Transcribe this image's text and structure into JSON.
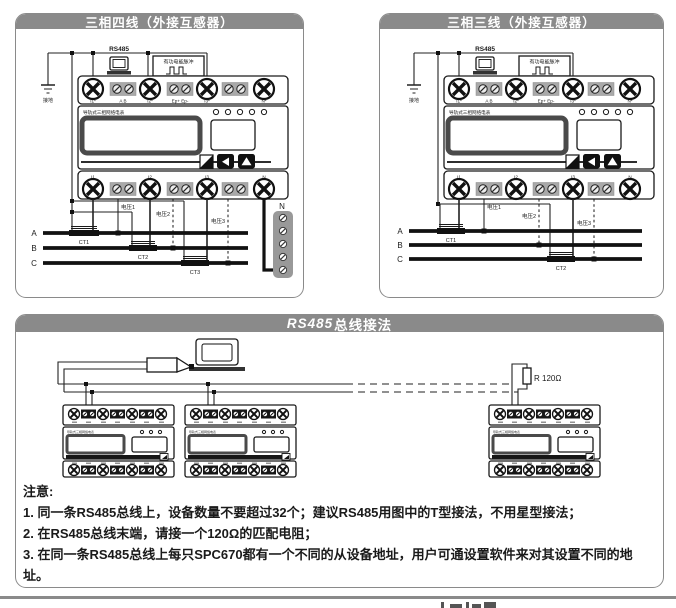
{
  "headers": {
    "four_wire": "三相四线（外接互感器）",
    "three_wire": "三相三线（外接互感器）",
    "rs485_latin": "RS485",
    "rs485_cjk": "总线接法"
  },
  "labels": {
    "ground": "接地",
    "rs485": "RS485",
    "pulse": "有功电能脉冲",
    "meter_name": "导轨式三相网络电表",
    "neutral_bus": "N",
    "resistor": "R 120Ω"
  },
  "meter": {
    "top_terminals": [
      "I1*",
      "A B",
      "I2*",
      "Ep+ Ep-",
      "I3*",
      "N*"
    ],
    "bottom_terminals": [
      "I1",
      "I2",
      "I3",
      "N"
    ]
  },
  "wiring": {
    "voltages": [
      "电压1",
      "电压2",
      "电压3"
    ],
    "phases": [
      "A",
      "B",
      "C"
    ],
    "cts": [
      "CT1",
      "CT2",
      "CT3"
    ]
  },
  "notes": {
    "title": "注意:",
    "items": [
      "1. 同一条RS485总线上，设备数量不要超过32个；建议RS485用图中的T型接法，不用星型接法；",
      "2. 在RS485总线末端，请接一个120Ω的匹配电阻；",
      "3. 在同一条RS485总线上每只SPC670都有一个不同的从设备地址，用户可通设置软件来对其设置不同的地址。"
    ]
  }
}
